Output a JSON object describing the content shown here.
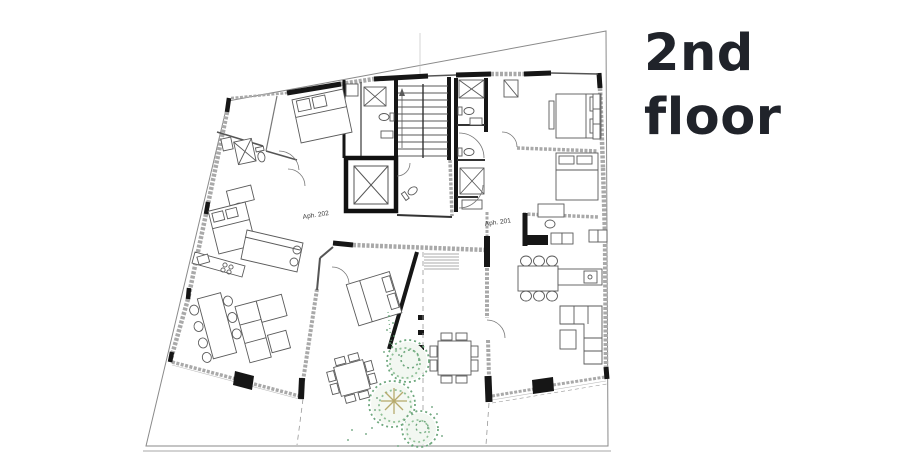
{
  "title": {
    "line1": "2nd",
    "line2": "floor"
  },
  "floorplan": {
    "labels": {
      "apartment_left": "Aph. 202",
      "apartment_right": "Aph. 201"
    }
  },
  "colors": {
    "background": "#ffffff",
    "title_text": "#20232a",
    "wall_black": "#161616",
    "glass_wall_gray": "#a9a9a9",
    "property_boundary": "#8a8a8a",
    "thin_line": "#5a5a5a",
    "tree_green_dark": "#5d9a6f",
    "tree_green_mid": "#6fa87e",
    "tree_green_light": "#8fc097",
    "palm_olive": "#b7aa6d"
  }
}
